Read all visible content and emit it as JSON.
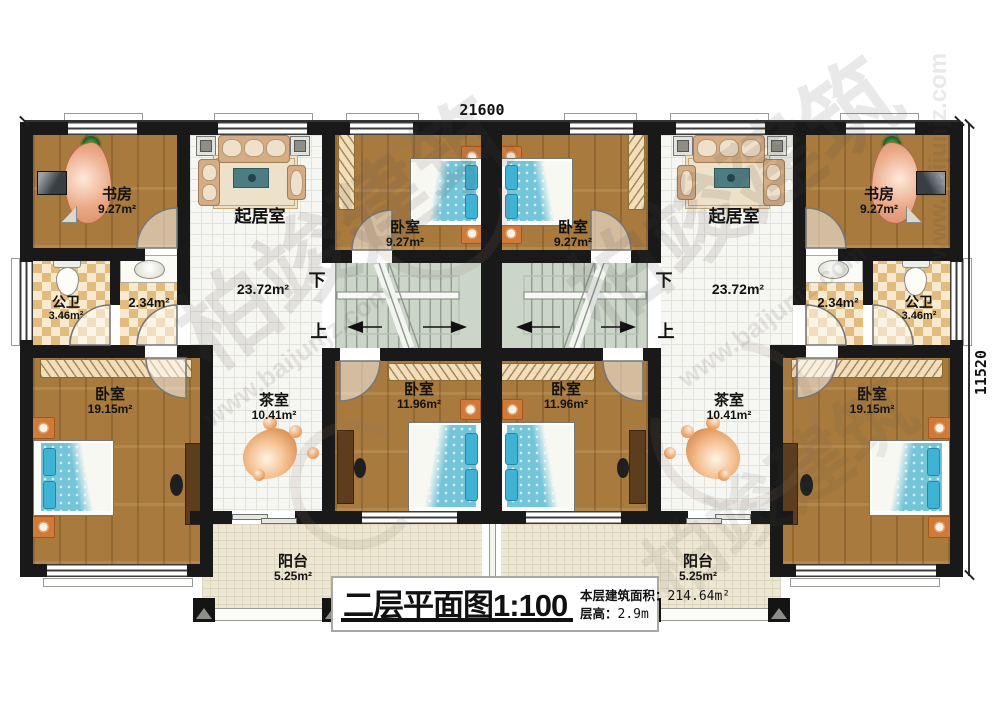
{
  "dimensions": {
    "width_mm": "21600",
    "height_mm": "11520"
  },
  "stair": {
    "down": "下",
    "up": "上"
  },
  "rooms": {
    "study": {
      "name": "书房",
      "area": "9.27m²"
    },
    "living": {
      "name": "起居室",
      "area": "23.72m²"
    },
    "bath": {
      "name": "公卫",
      "area": "3.46m²"
    },
    "vanity": {
      "area": "2.34m²"
    },
    "bedroom_mid": {
      "name": "卧室",
      "area": "9.27m²"
    },
    "bedroom_low": {
      "name": "卧室",
      "area": "11.96m²"
    },
    "bedroom_big": {
      "name": "卧室",
      "area": "19.15m²"
    },
    "tea": {
      "name": "茶室",
      "area": "10.41m²"
    },
    "balcony": {
      "name": "阳台",
      "area": "5.25m²"
    }
  },
  "title": {
    "main": "二层平面图1:100",
    "area_label": "本层建筑面积：",
    "area_value": "214.64m²",
    "floor_height_label": "层高：",
    "floor_height_value": "2.9m"
  },
  "watermark": {
    "brand": "柏竣建筑",
    "site": "www.baijunjz.com"
  }
}
